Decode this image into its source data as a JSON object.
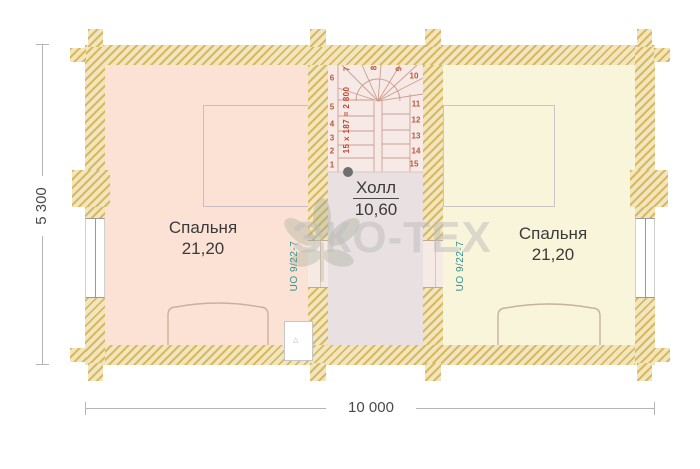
{
  "rooms": {
    "bedroom_left": {
      "name": "Спальня",
      "area": "21,20"
    },
    "hall": {
      "name": "Холл",
      "area": "10,60"
    },
    "bedroom_right": {
      "name": "Спальня",
      "area": "21,20"
    }
  },
  "stairs": {
    "formula": "15 x 187 = 2 800",
    "step_numbers": [
      "1",
      "2",
      "3",
      "4",
      "5",
      "6",
      "7",
      "8",
      "9",
      "10",
      "11",
      "12",
      "13",
      "14",
      "15"
    ]
  },
  "annotations": {
    "heating_left": "UO 9/22-7",
    "heating_right": "UO 9/22-7"
  },
  "dimensions": {
    "vertical": "5 300",
    "horizontal": "10 000"
  },
  "watermark": "ЭКО-ТЕХ",
  "colors": {
    "wall_hatch_dark": "#d9b863",
    "wall_hatch_light": "#f2e6bf",
    "bedroom_left_fill": "#fbe2d4",
    "hall_fill": "#e9e0e1",
    "bedroom_right_fill": "#f9f5da",
    "stairs_fill": "#f7eae6",
    "stair_text": "#b85838",
    "stair_formula_text": "#c0452f",
    "heating_text": "#2f9090",
    "label_text": "#3b3b3b",
    "dimension_text": "#4a4a4a",
    "watermark_gray": "#bdbdbd"
  }
}
